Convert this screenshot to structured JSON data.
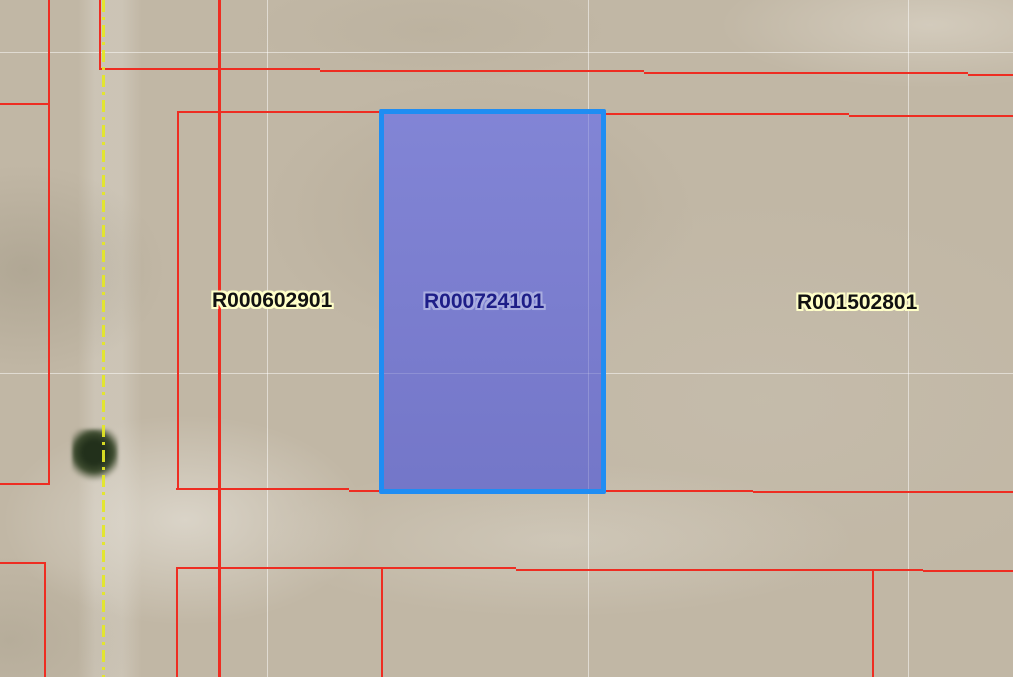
{
  "map": {
    "view": "parcel-gis-aerial-view",
    "labels": {
      "left_parcel": "R000602901",
      "selected_parcel": "R000724101",
      "right_parcel": "R001502801"
    },
    "colors": {
      "aerial_background": "#c1b7a5",
      "parcel_boundary_line": "#ee2d22",
      "road_centerline": "#e4e824",
      "section_line": "#ffffff",
      "selected_parcel_fill": "#7b7ed3",
      "selected_parcel_border": "#1f8df3",
      "selected_label_text": "#1e1e88",
      "selected_label_halo": "#a9ade0",
      "parcel_label_text": "#111111",
      "parcel_label_halo": "#ffffc8"
    }
  }
}
